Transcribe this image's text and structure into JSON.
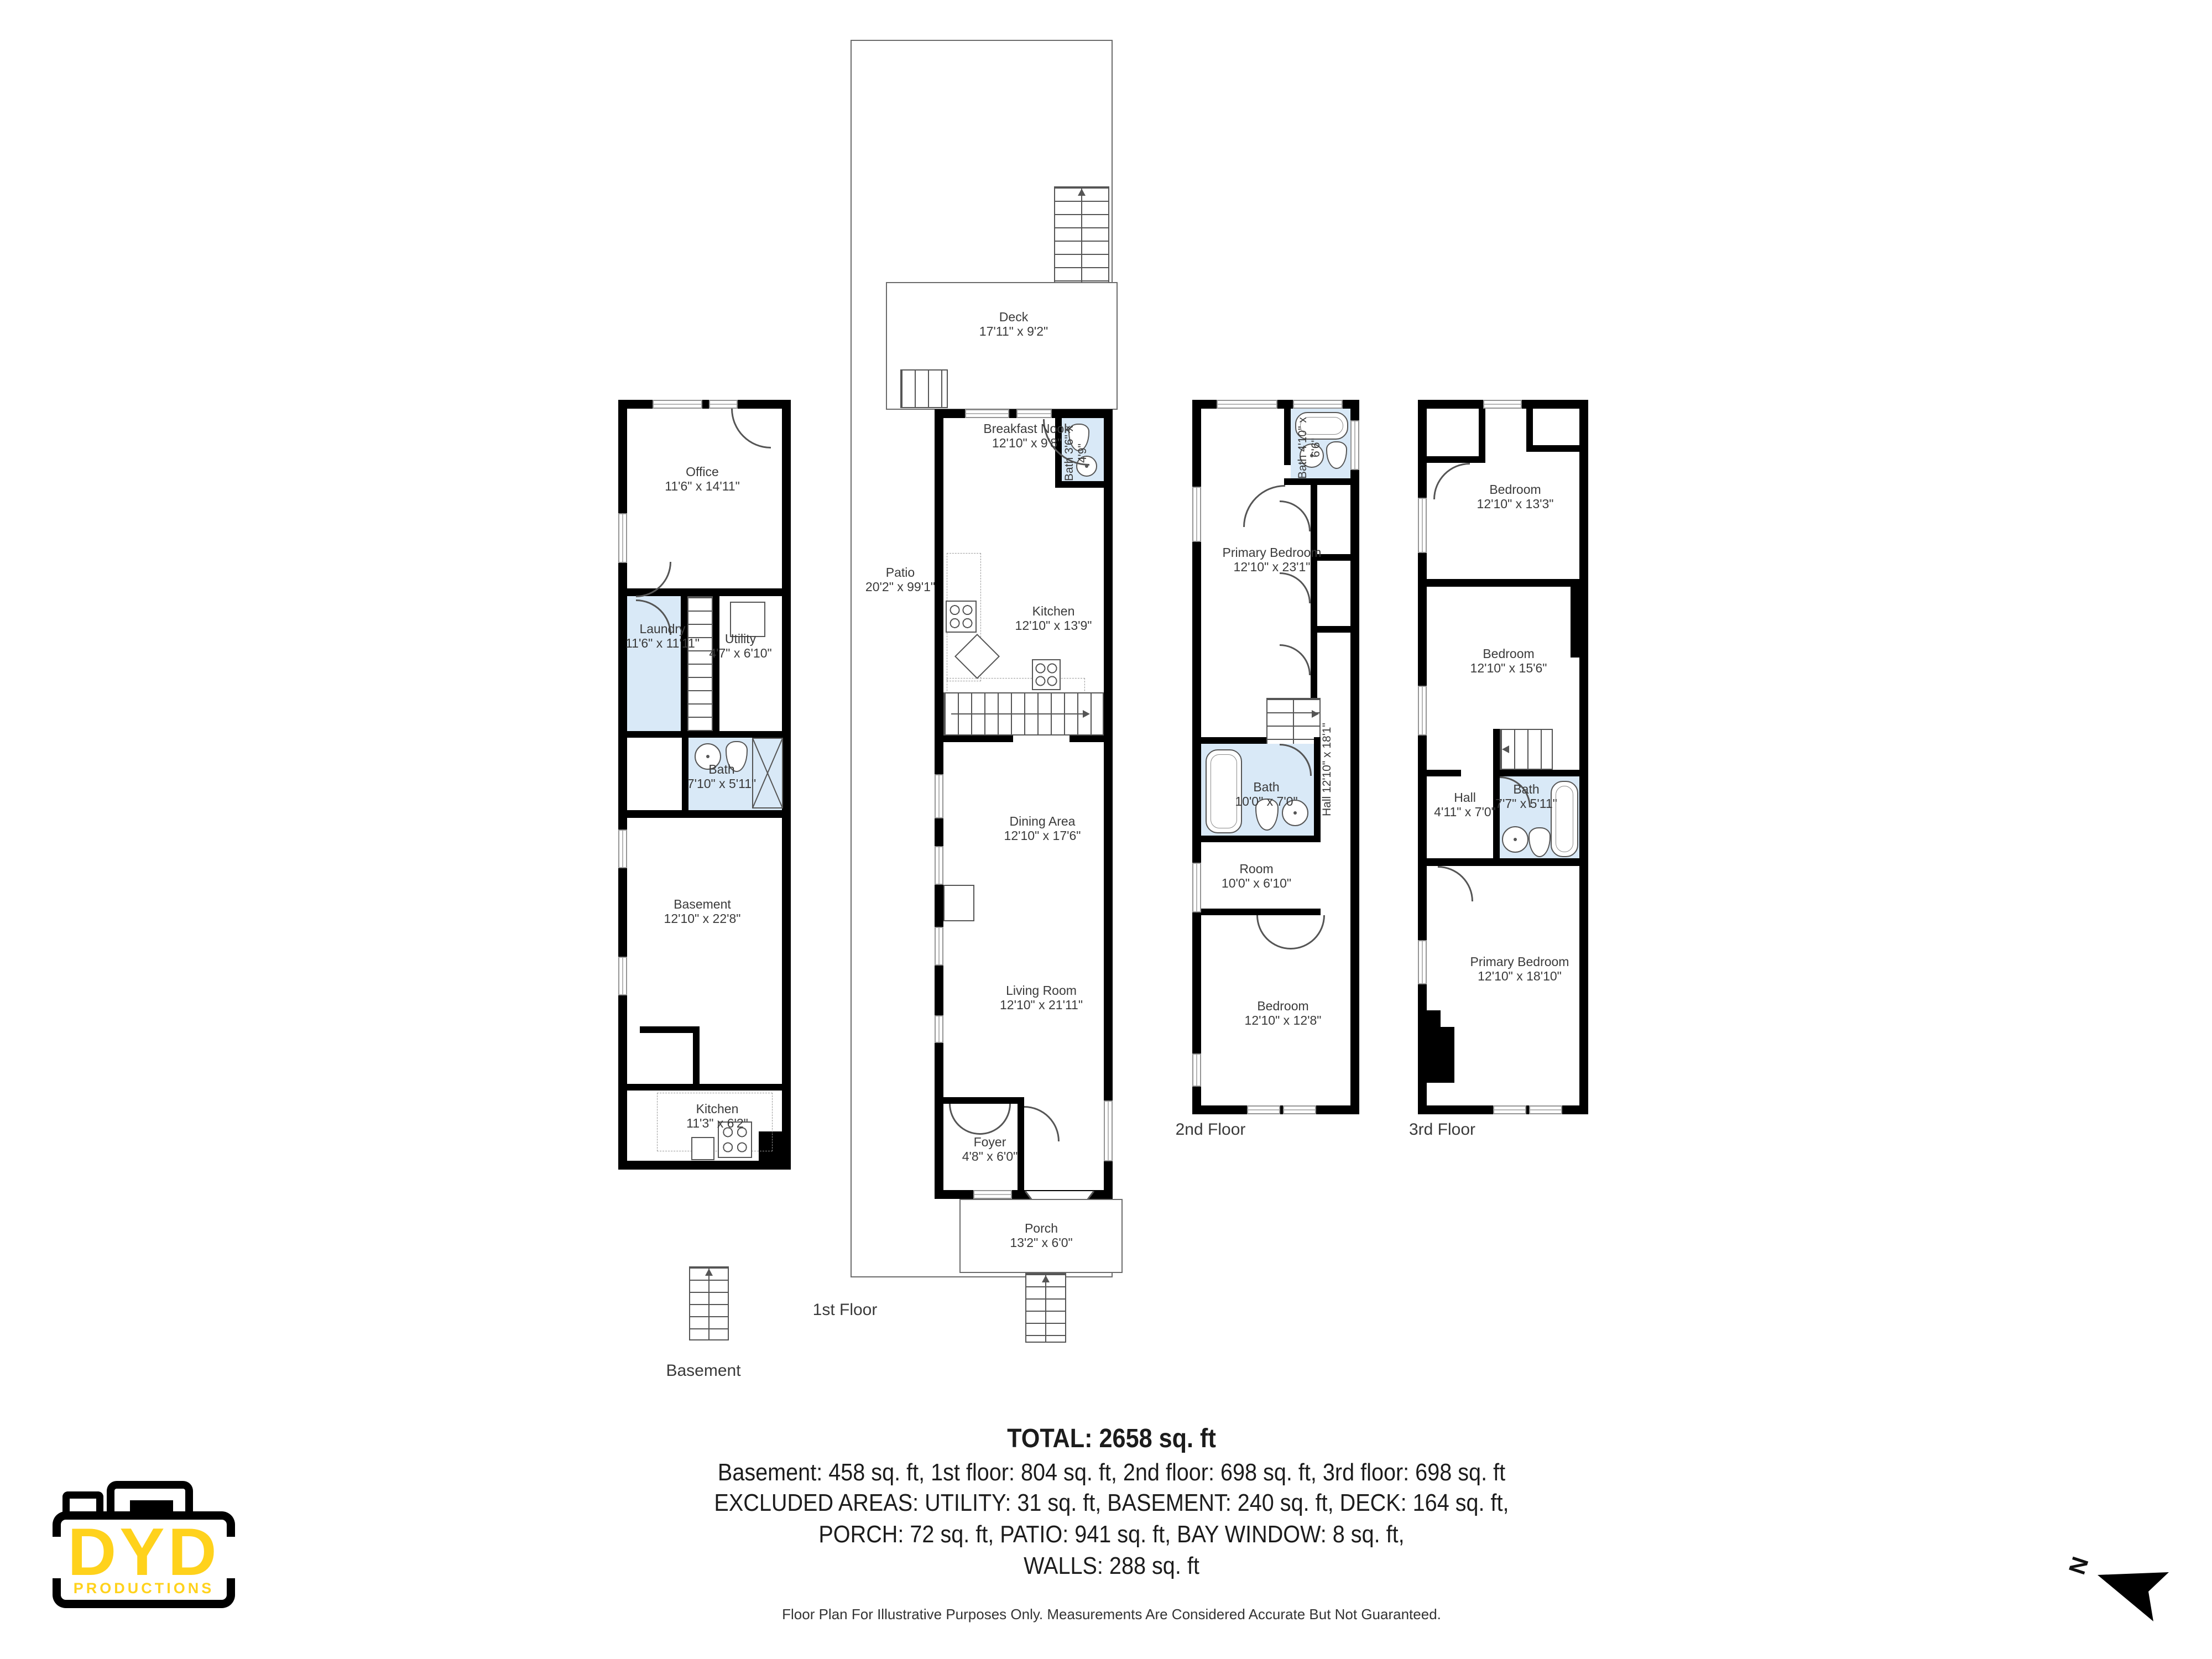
{
  "page": {
    "background": "#ffffff",
    "wall_color": "#000000",
    "bath_fill": "#d9e9f7",
    "logo_yellow": "#ffd21c"
  },
  "floors": {
    "basement": {
      "caption": "Basement",
      "rooms": {
        "office": {
          "name": "Office",
          "dims": "11'6\" x 14'11\""
        },
        "utility": {
          "name": "Utility",
          "dims": "4'7\" x 6'10\""
        },
        "laundry": {
          "name": "Laundry",
          "dims": "11'6\" x 11'11\""
        },
        "bath": {
          "name": "Bath",
          "dims": "7'10\" x 5'11\""
        },
        "basement": {
          "name": "Basement",
          "dims": "12'10\" x 22'8\""
        },
        "kitchen": {
          "name": "Kitchen",
          "dims": "11'3\" x 6'2\""
        }
      }
    },
    "first": {
      "caption": "1st Floor",
      "rooms": {
        "deck": {
          "name": "Deck",
          "dims": "17'11\" x 9'2\""
        },
        "patio": {
          "name": "Patio",
          "dims": "20'2\" x 99'1\""
        },
        "breakfast_nook": {
          "name": "Breakfast Nook",
          "dims": "12'10\" x 9'8\""
        },
        "bath": {
          "name": "Bath",
          "dims": "3'6\" x 4'9\""
        },
        "kitchen": {
          "name": "Kitchen",
          "dims": "12'10\" x 13'9\""
        },
        "dining": {
          "name": "Dining Area",
          "dims": "12'10\" x 17'6\""
        },
        "living": {
          "name": "Living Room",
          "dims": "12'10\" x 21'11\""
        },
        "foyer": {
          "name": "Foyer",
          "dims": "4'8\" x 6'0\""
        },
        "porch": {
          "name": "Porch",
          "dims": "13'2\" x 6'0\""
        }
      }
    },
    "second": {
      "caption": "2nd Floor",
      "rooms": {
        "bath_top": {
          "name": "Bath",
          "dims": "4'10\" x 6'6\""
        },
        "primary": {
          "name": "Primary Bedroom",
          "dims": "12'10\" x 23'1\""
        },
        "bath": {
          "name": "Bath",
          "dims": "10'0\" x 7'0\""
        },
        "hall": {
          "name": "Hall",
          "dims": "12'10\" x 18'1\""
        },
        "room": {
          "name": "Room",
          "dims": "10'0\" x 6'10\""
        },
        "bedroom": {
          "name": "Bedroom",
          "dims": "12'10\" x 12'8\""
        }
      }
    },
    "third": {
      "caption": "3rd Floor",
      "rooms": {
        "bedroom_top": {
          "name": "Bedroom",
          "dims": "12'10\" x 13'3\""
        },
        "bedroom_mid": {
          "name": "Bedroom",
          "dims": "12'10\" x 15'6\""
        },
        "hall": {
          "name": "Hall",
          "dims": "4'11\" x 7'0\""
        },
        "bath": {
          "name": "Bath",
          "dims": "7'7\" x 5'11\""
        },
        "primary": {
          "name": "Primary Bedroom",
          "dims": "12'10\" x 18'10\""
        }
      }
    }
  },
  "summary": {
    "total": "TOTAL: 2658 sq. ft",
    "line1": "Basement: 458 sq. ft, 1st floor: 804 sq. ft, 2nd floor: 698 sq. ft, 3rd floor: 698 sq. ft",
    "line2": "EXCLUDED AREAS: UTILITY: 31 sq. ft, BASEMENT: 240 sq. ft, DECK: 164 sq. ft,",
    "line3": "PORCH: 72 sq. ft, PATIO: 941 sq. ft, BAY WINDOW: 8 sq. ft,",
    "line4": "WALLS: 288 sq. ft",
    "disclaimer": "Floor Plan For Illustrative Purposes Only. Measurements Are Considered Accurate But Not Guaranteed."
  },
  "logo": {
    "name": "DYD",
    "sub": "PRODUCTIONS"
  },
  "compass": {
    "label": "N"
  }
}
